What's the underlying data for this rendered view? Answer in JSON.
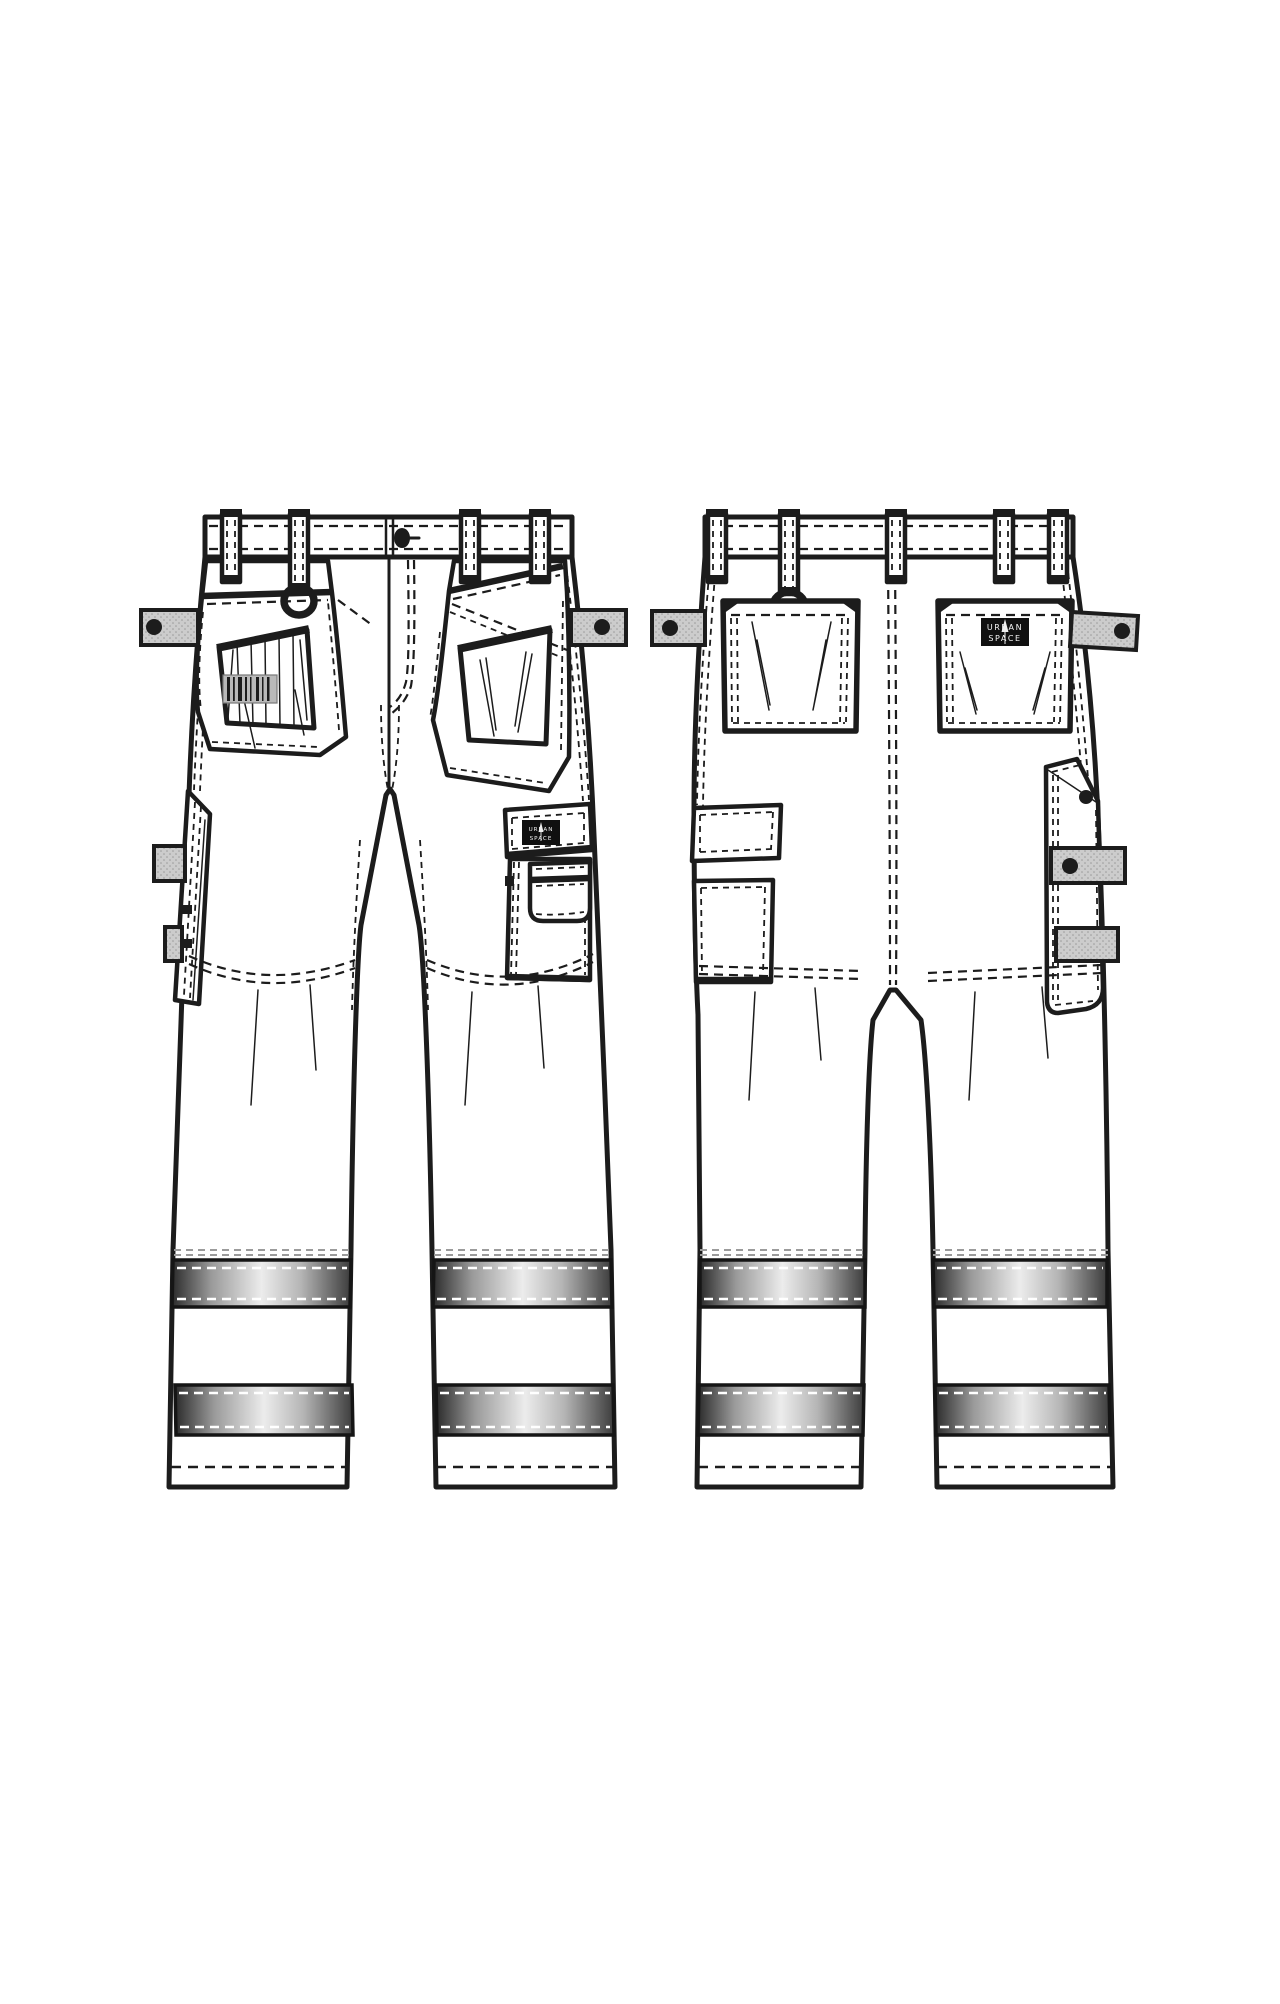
{
  "sketch": {
    "garment": "hi-vis work trousers technical flat",
    "views": [
      {
        "id": "front",
        "label": "front view"
      },
      {
        "id": "back",
        "label": "back view"
      }
    ],
    "brand_label": {
      "line1": "URBAN",
      "line2": "SPACE"
    },
    "id_patch": {
      "style": "hatched barcode patch"
    },
    "reflective_stripes_per_leg": 2,
    "belt_loops": {
      "front": 4,
      "back": 5
    },
    "hardware": {
      "waist_buttons": 1,
      "d_rings": 2,
      "snap_dots": 5
    },
    "parts": {
      "front": [
        "left hanging tool pocket",
        "right hanging tool pocket",
        "cargo pocket with flap",
        "phone pocket",
        "hammer loop side panel"
      ],
      "back": [
        "left patch pocket",
        "right patch pocket with brand label",
        "left side flap pocket",
        "right side tool pocket"
      ]
    }
  },
  "colors": {
    "paper": "#ffffff",
    "ink": "#1c1c1c",
    "tab_fill": "#cccccc",
    "label_bg": "#101010",
    "label_text": "#f5f5f5",
    "id_patch_fill": "#b9b9b9",
    "stripe_dark": "#2b2b2b",
    "stripe_light": "#ececec",
    "stripe_end": "#3c3c3c"
  }
}
